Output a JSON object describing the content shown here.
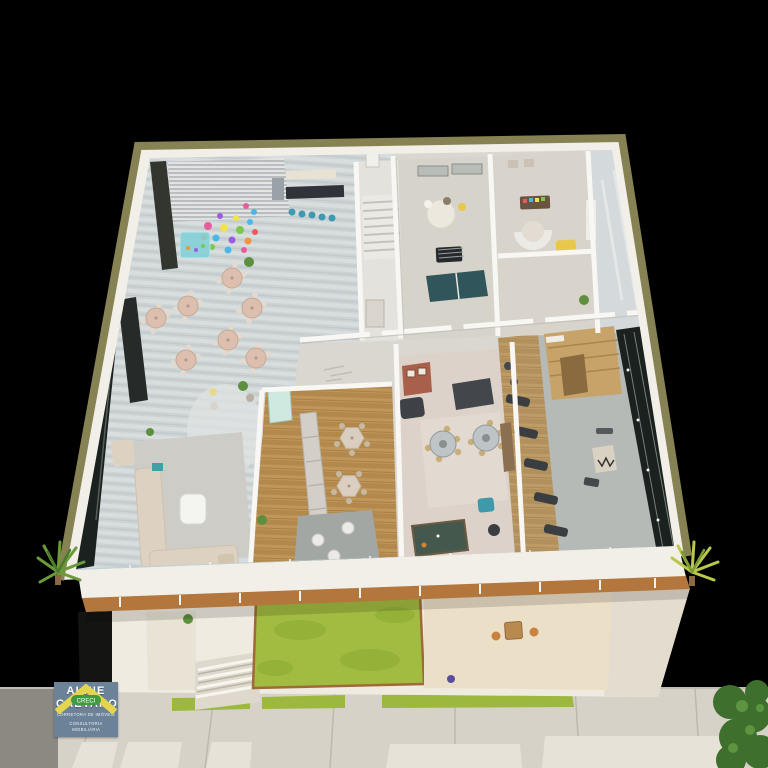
{
  "logo": {
    "creci_banner": "CRECI",
    "name_line1": "ALINE",
    "name_line2": "CAETANO",
    "subtitle_line1": "CORRETORA DE IMÓVEIS",
    "subtitle_line2": "CONSULTORIA IMOBILIÁRIA"
  },
  "icons": {
    "logo_icon": "house-roof-icon"
  },
  "scene": {
    "type": "3d-floor-plan-render",
    "areas": [
      "party-room",
      "kids-balloon-corner",
      "kitchen-bar",
      "lounge",
      "gourmet-hall",
      "dining-room",
      "games-room",
      "stair-hall",
      "kids-playroom",
      "gym",
      "sauna",
      "balcony",
      "front-lawn",
      "street-terrace",
      "sidewalk"
    ]
  },
  "colors": {
    "background": "#000000",
    "trim_gold": "#878253",
    "parapet": "#f1efe8",
    "floor_base": "#d9d7d0",
    "lawn": "#a2bb41",
    "grass_strip": "#9cb83e",
    "wood_band": "#b3763d",
    "facade": "#f0ebe0",
    "sidewalk": "#d7d2c8",
    "hedge": "#3f6f2c",
    "glass_dark": "#1b211e",
    "logo_blue": "#6b8299",
    "logo_roof_yellow": "#e5d44e",
    "logo_banner_green": "#3f9a41"
  }
}
